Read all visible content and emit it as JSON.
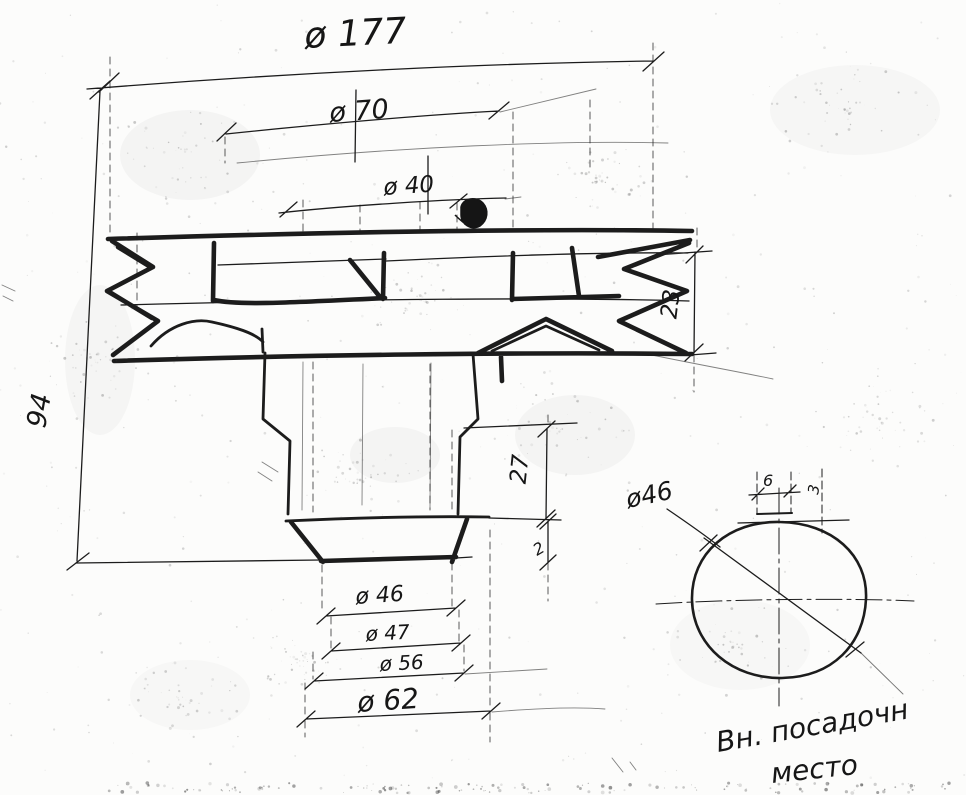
{
  "drawing": {
    "kind": "hand-drawn pulley cross-section sketch",
    "dims": {
      "outer_diameter": "ø 177",
      "hub_diameter": "ø 70",
      "top_bore": "ø 40",
      "overall_height": "94",
      "rim_width": "23",
      "step_height": "27",
      "chamfer": "2",
      "end_dia_1": "ø 46",
      "end_dia_2": "ø 47",
      "end_dia_3": "ø 56",
      "end_dia_4": "ø 62"
    },
    "detail": {
      "bore_diameter": "ø46",
      "keyway_width": "6",
      "keyway_depth": "3",
      "caption_line1": "Вн. посадочн",
      "caption_line2": "место"
    },
    "colors": {
      "paper": "#fcfcfb",
      "ink": "#1c1c1c"
    }
  }
}
